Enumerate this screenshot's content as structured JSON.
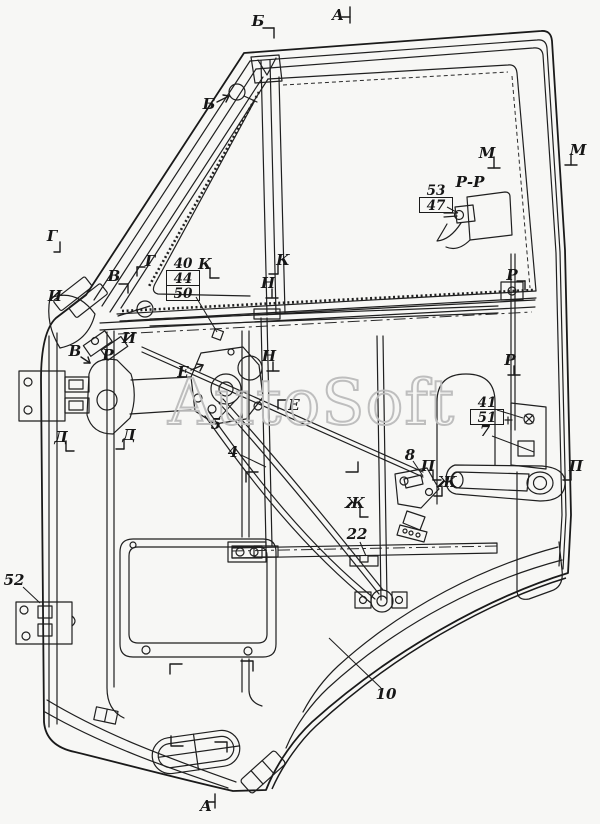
{
  "watermark": "AutoSoft",
  "colors": {
    "line": "#1f1f1f",
    "background": "#f7f7f5",
    "watermark_stroke": "#bcbcbc"
  },
  "annotations": {
    "letters": [
      {
        "text": "Б",
        "x": 258,
        "y": 21,
        "tick": [
          [
            5,
            7,
            16,
            7
          ],
          [
            16,
            7,
            16,
            17
          ]
        ]
      },
      {
        "text": "А",
        "x": 338,
        "y": 15,
        "tick": [
          [
            12,
            -8,
            12,
            8
          ],
          [
            4,
            2,
            12,
            2
          ]
        ]
      },
      {
        "text": "Б",
        "x": 209,
        "y": 104,
        "tick": [
          [
            8,
            -2,
            20,
            -8
          ],
          [
            20,
            -8,
            14,
            -9
          ],
          [
            20,
            -8,
            17,
            -2
          ]
        ]
      },
      {
        "text": "Г",
        "x": 52,
        "y": 236,
        "tick": [
          [
            8,
            6,
            8,
            16
          ],
          [
            2,
            16,
            8,
            16
          ]
        ]
      },
      {
        "text": "В",
        "x": 114,
        "y": 276,
        "tick": [
          [
            5,
            8,
            14,
            8
          ],
          [
            14,
            8,
            14,
            17
          ]
        ]
      },
      {
        "text": "И",
        "x": 55,
        "y": 296,
        "tick": []
      },
      {
        "text": "В",
        "x": 75,
        "y": 351,
        "tick": [
          [
            6,
            6,
            15,
            12
          ],
          [
            15,
            12,
            9,
            12
          ],
          [
            15,
            12,
            13,
            6
          ]
        ]
      },
      {
        "text": "Р",
        "x": 108,
        "y": 355,
        "tick": []
      },
      {
        "text": "И",
        "x": 129,
        "y": 338,
        "tick": []
      },
      {
        "text": "Г",
        "x": 150,
        "y": 261,
        "tick": [
          [
            -5,
            6,
            -13,
            6
          ],
          [
            -13,
            6,
            -13,
            15
          ]
        ]
      },
      {
        "text": "К",
        "x": 205,
        "y": 264,
        "tick": [
          [
            5,
            4,
            5,
            14
          ],
          [
            5,
            14,
            14,
            14
          ]
        ]
      },
      {
        "text": "К",
        "x": 283,
        "y": 260,
        "tick": [
          [
            -5,
            4,
            -5,
            14
          ],
          [
            -14,
            14,
            -5,
            14
          ]
        ]
      },
      {
        "text": "Н",
        "x": 268,
        "y": 283,
        "tick": [
          [
            4,
            6,
            4,
            15
          ],
          [
            -2,
            15,
            10,
            15
          ]
        ]
      },
      {
        "text": "Н",
        "x": 269,
        "y": 356,
        "tick": [
          [
            4,
            6,
            4,
            15
          ],
          [
            -2,
            15,
            10,
            15
          ]
        ]
      },
      {
        "text": "М",
        "x": 487,
        "y": 153,
        "tick": [
          [
            7,
            4,
            7,
            15
          ],
          [
            1,
            15,
            13,
            15
          ]
        ]
      },
      {
        "text": "М",
        "x": 578,
        "y": 150,
        "tick": [
          [
            -7,
            4,
            -7,
            15
          ],
          [
            -13,
            15,
            -1,
            15
          ]
        ]
      },
      {
        "text": "Р-Р",
        "x": 470,
        "y": 182,
        "tick": []
      },
      {
        "text": "Р",
        "x": 512,
        "y": 275,
        "tick": [
          [
            5,
            6,
            13,
            6
          ],
          [
            13,
            6,
            13,
            15
          ]
        ]
      },
      {
        "text": "Р",
        "x": 510,
        "y": 360,
        "tick": [
          [
            4,
            6,
            4,
            15
          ],
          [
            -2,
            15,
            10,
            15
          ]
        ]
      },
      {
        "text": "Е",
        "x": 183,
        "y": 372,
        "tick": [
          [
            8,
            -2,
            20,
            -7
          ],
          [
            20,
            -7,
            14,
            -8
          ],
          [
            20,
            -7,
            17,
            -1
          ]
        ]
      },
      {
        "text": "Е",
        "x": 294,
        "y": 405,
        "tick": [
          [
            -7,
            -5,
            -16,
            -5
          ],
          [
            -16,
            -5,
            -16,
            4
          ]
        ]
      },
      {
        "text": "Д",
        "x": 61,
        "y": 437,
        "tick": [
          [
            5,
            4,
            5,
            14
          ],
          [
            5,
            14,
            13,
            14
          ]
        ]
      },
      {
        "text": "Д",
        "x": 129,
        "y": 435,
        "tick": [
          [
            -5,
            4,
            -5,
            14
          ],
          [
            -13,
            14,
            -5,
            14
          ]
        ]
      },
      {
        "text": "Ж",
        "x": 355,
        "y": 503,
        "tick": [
          [
            5,
            4,
            5,
            14
          ],
          [
            5,
            14,
            13,
            14
          ]
        ]
      },
      {
        "text": "Ж",
        "x": 447,
        "y": 482,
        "tick": [
          [
            -5,
            4,
            -5,
            14
          ],
          [
            -13,
            14,
            -5,
            14
          ]
        ]
      },
      {
        "text": "П",
        "x": 428,
        "y": 466,
        "tick": [
          [
            5,
            4,
            5,
            14
          ],
          [
            5,
            14,
            13,
            14
          ]
        ]
      },
      {
        "text": "П",
        "x": 576,
        "y": 466,
        "tick": [
          [
            -5,
            4,
            -5,
            14
          ],
          [
            -13,
            14,
            -5,
            14
          ]
        ]
      },
      {
        "text": "А",
        "x": 206,
        "y": 806,
        "tick": [
          [
            9,
            -12,
            9,
            2
          ],
          [
            1,
            -4,
            9,
            -4
          ]
        ]
      }
    ],
    "callouts": [
      {
        "text": "5",
        "x": 216,
        "y": 424
      },
      {
        "text": "4",
        "x": 233,
        "y": 452
      },
      {
        "text": "7",
        "x": 485,
        "y": 431
      },
      {
        "text": "8",
        "x": 410,
        "y": 455
      },
      {
        "text": "22",
        "x": 357,
        "y": 534
      },
      {
        "text": "10",
        "x": 386,
        "y": 694
      },
      {
        "text": "52",
        "x": 14,
        "y": 580
      }
    ],
    "stacks": [
      {
        "x": 166,
        "y": 256,
        "rows": [
          {
            "text": "40",
            "boxed": false
          },
          {
            "text": "44",
            "boxed": true
          },
          {
            "text": "50",
            "boxed": true
          }
        ]
      },
      {
        "x": 419,
        "y": 183,
        "rows": [
          {
            "text": "53",
            "boxed": false
          },
          {
            "text": "47",
            "boxed": true
          }
        ]
      },
      {
        "x": 470,
        "y": 395,
        "rows": [
          {
            "text": "41",
            "boxed": false
          },
          {
            "text": "51",
            "boxed": true
          }
        ]
      }
    ]
  }
}
